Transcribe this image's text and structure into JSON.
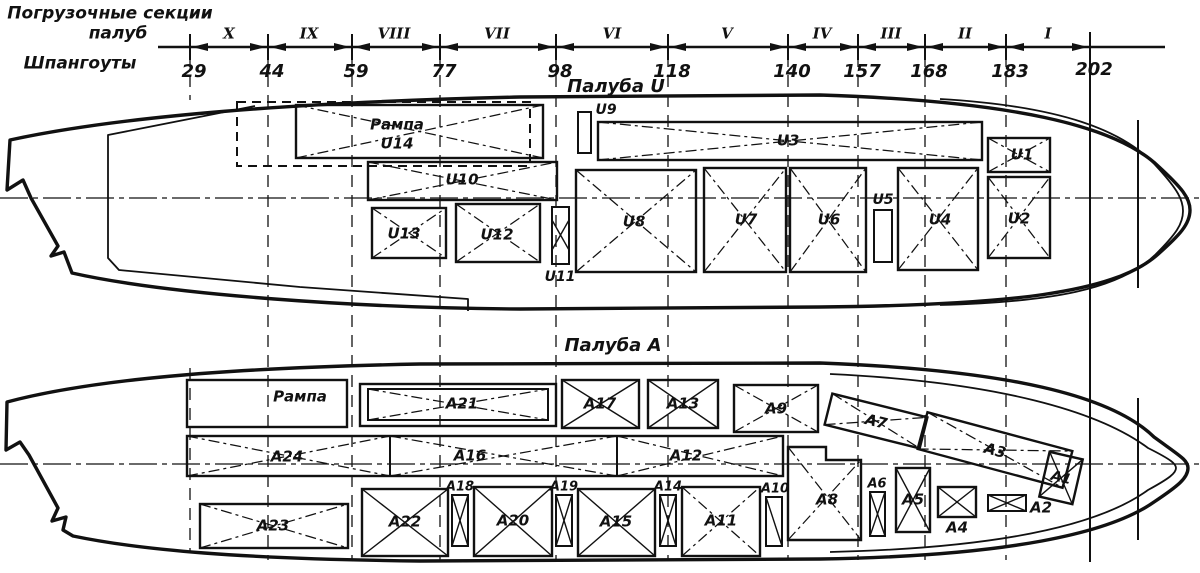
{
  "header": {
    "title_line1": "Погрузочные секции",
    "title_line2": "палуб",
    "frames_label": "Шпангоуты",
    "frames": [
      "29",
      "44",
      "59",
      "77",
      "98",
      "118",
      "140",
      "157",
      "168",
      "183",
      "202"
    ],
    "sections": [
      "X",
      "IX",
      "VIII",
      "VII",
      "VI",
      "V",
      "IV",
      "III",
      "II",
      "I"
    ]
  },
  "deck_u": {
    "title": "Палуба U",
    "ramp_label": "Рампа",
    "ramp_id": "U14",
    "sections": {
      "u1": "U1",
      "u2": "U2",
      "u3": "U3",
      "u4": "U4",
      "u5": "U5",
      "u6": "U6",
      "u7": "U7",
      "u8": "U8",
      "u9": "U9",
      "u10": "U10",
      "u11": "U11",
      "u12": "U12",
      "u13": "U13"
    }
  },
  "deck_a": {
    "title": "Палуба А",
    "ramp_label": "Рампа",
    "sections": {
      "a1": "A1",
      "a2": "A2",
      "a3": "A3",
      "a4": "A4",
      "a5": "A5",
      "a6": "A6",
      "a7": "A7",
      "a8": "A8",
      "a9": "A9",
      "a10": "A10",
      "a11": "A11",
      "a12": "A12",
      "a13": "A13",
      "a14": "A14",
      "a15": "A15",
      "a16": "A16",
      "a17": "A17",
      "a18": "A18",
      "a19": "A19",
      "a20": "A20",
      "a21": "A21",
      "a22": "A22",
      "a23": "A23",
      "a24": "A24"
    }
  }
}
